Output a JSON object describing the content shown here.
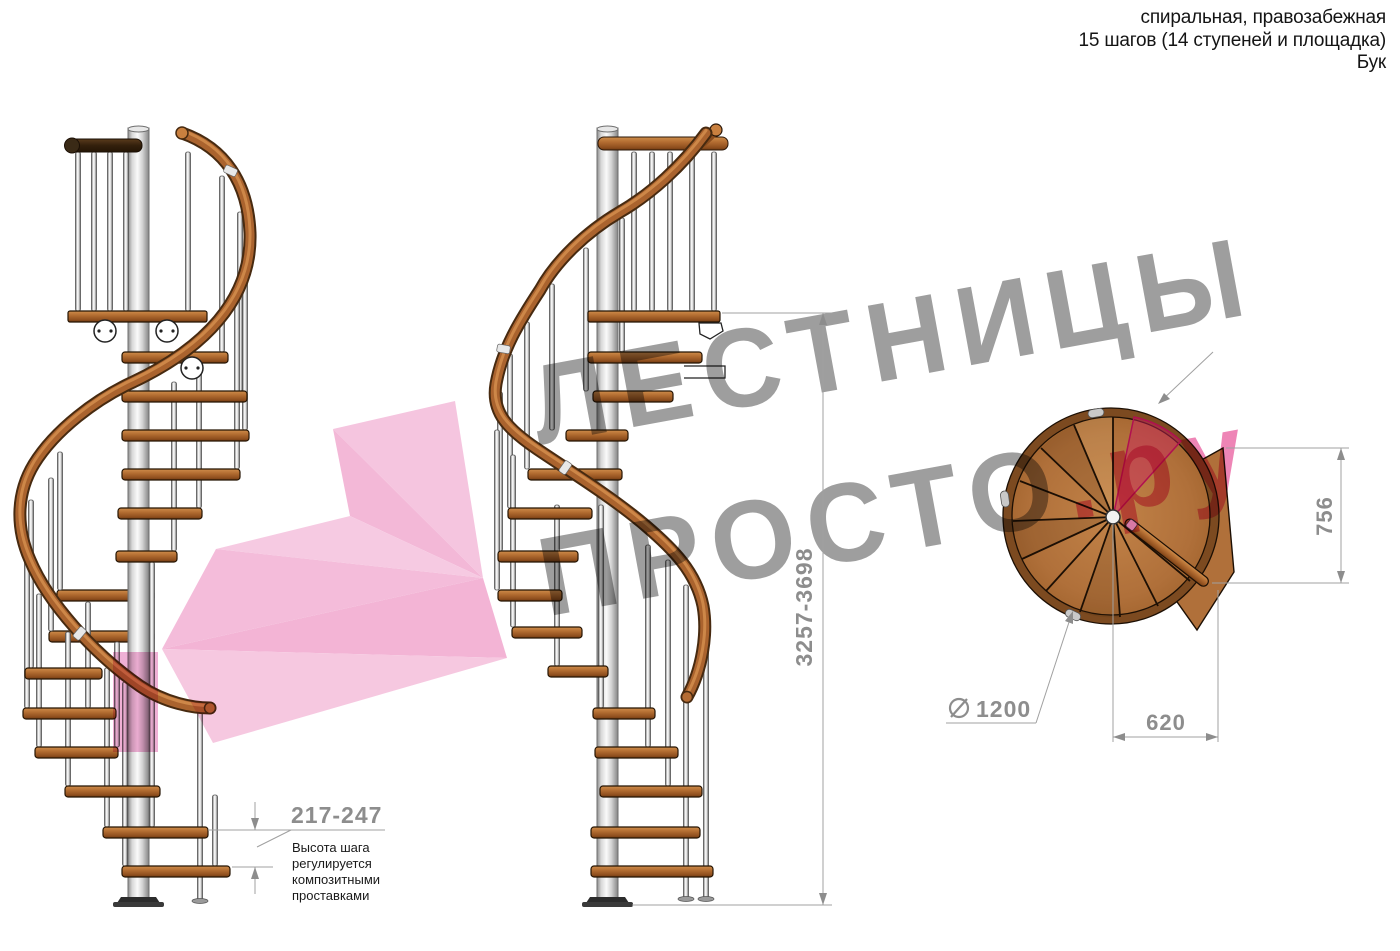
{
  "header": {
    "line1": "спиральная, правозабежная",
    "line2": "15 шагов (14 ступеней и площадка)",
    "line3": "Бук"
  },
  "watermark": {
    "word1": "ЛЕСТНИЦЫ",
    "word2": "ПРОСТО",
    "word2_suffix": ".ру",
    "gray": "#9e9e9e",
    "pink": "#ee85b6"
  },
  "dimensions": {
    "total_height": "3257-3698",
    "step_height": "217-247",
    "step_height_note": "Высота шага\nрегулируется\nкомпозитными\nпроставками",
    "plan_depth": "756",
    "plan_width": "620",
    "diameter_symbol": "∅",
    "diameter_value": "1200"
  },
  "colors": {
    "dimension_gray": "#8d8d8d",
    "wood": "#b06a32",
    "pole": "#d8d8d8",
    "highlight_pink": "#f4bcdb",
    "plan_step_highlight": "#c81e60"
  }
}
